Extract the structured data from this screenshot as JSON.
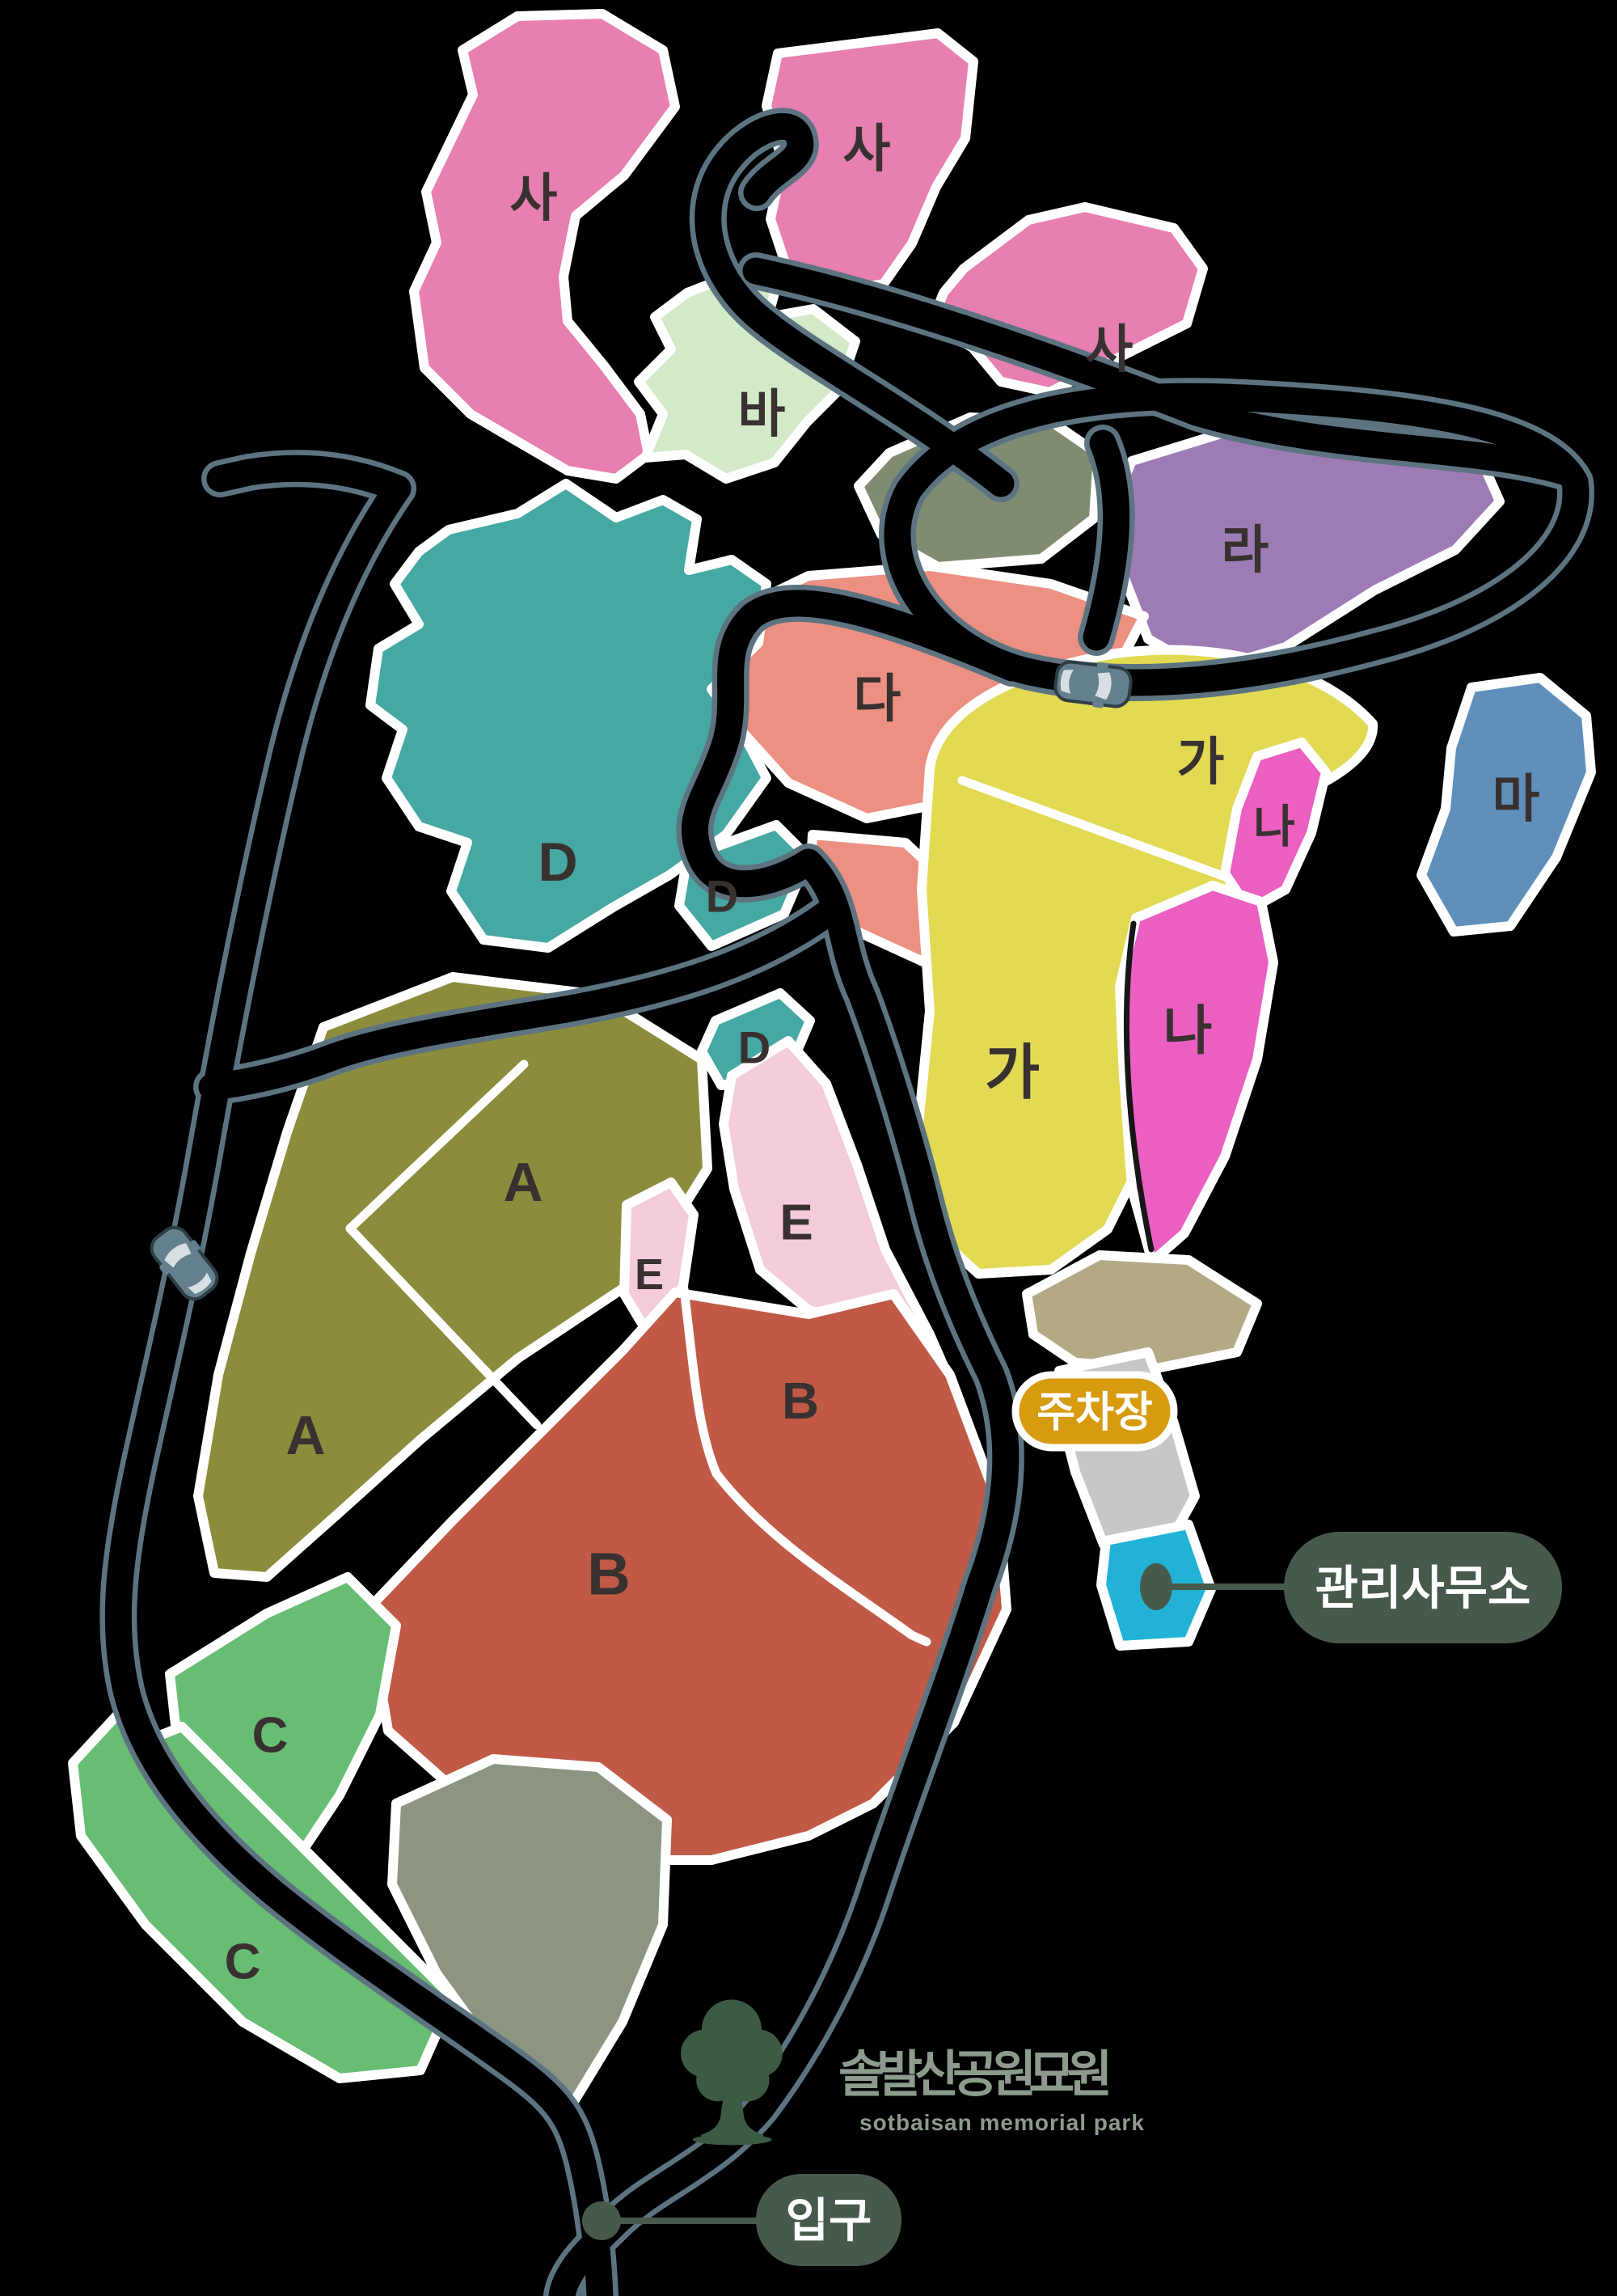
{
  "map": {
    "logo": {
      "title": "솔발산공원묘원",
      "subtitle": "sotbaisan memorial park",
      "tree_color": "#3d5a44",
      "text_color": "#8c9b8c"
    },
    "badges": {
      "parking": {
        "label": "주차장",
        "bg": "#d79b10"
      },
      "office": {
        "label": "관리사무소",
        "bg": "#47594b"
      },
      "entrance": {
        "label": "입구",
        "bg": "#47594b"
      }
    },
    "colors": {
      "background": "#000000",
      "road_edge": "#5d7380",
      "zone_outline": "#ffffff",
      "label_text": "#383130",
      "car": "#64808c"
    },
    "zones": [
      {
        "name": "sa-1",
        "label": "사",
        "color": "#e77fb0"
      },
      {
        "name": "sa-2",
        "label": "사",
        "color": "#e77fb0"
      },
      {
        "name": "sa-3",
        "label": "사",
        "color": "#e77fb0"
      },
      {
        "name": "ba",
        "label": "바",
        "color": "#d3e9c8"
      },
      {
        "name": "hill-top",
        "label": "",
        "color": "#7f8c72"
      },
      {
        "name": "ra",
        "label": "라",
        "color": "#9d7cb5"
      },
      {
        "name": "da",
        "label": "다",
        "color": "#ec9082"
      },
      {
        "name": "da-lower",
        "label": "",
        "color": "#ec9082"
      },
      {
        "name": "d-1",
        "label": "D",
        "color": "#45a8a2"
      },
      {
        "name": "d-2",
        "label": "D",
        "color": "#45a8a2"
      },
      {
        "name": "d-3",
        "label": "D",
        "color": "#45a8a2"
      },
      {
        "name": "ma",
        "label": "마",
        "color": "#5f8fba"
      },
      {
        "name": "ga",
        "label": "가",
        "color": "#e2da52"
      },
      {
        "name": "na-1",
        "label": "나",
        "color": "#ea5fc0"
      },
      {
        "name": "na-2",
        "label": "나",
        "color": "#ea5fc0"
      },
      {
        "name": "a",
        "label": "A",
        "color": "#8b8d3c"
      },
      {
        "name": "e-1",
        "label": "E",
        "color": "#f3cbdb"
      },
      {
        "name": "e-2",
        "label": "E",
        "color": "#f3cbdb"
      },
      {
        "name": "b",
        "label": "B",
        "color": "#c05a47"
      },
      {
        "name": "c-1",
        "label": "C",
        "color": "#67bd72"
      },
      {
        "name": "c-2",
        "label": "C",
        "color": "#67bd72"
      },
      {
        "name": "hill-bottom",
        "label": "",
        "color": "#8b9581"
      },
      {
        "name": "parking-apron",
        "label": "",
        "color": "#b3aa85"
      },
      {
        "name": "parking-strip",
        "label": "",
        "color": "#c7c7c5"
      },
      {
        "name": "office-site",
        "label": "",
        "color": "#22b2d6"
      }
    ],
    "labels": [
      {
        "text": "사"
      },
      {
        "text": "사"
      },
      {
        "text": "사"
      },
      {
        "text": "바"
      },
      {
        "text": "라"
      },
      {
        "text": "다"
      },
      {
        "text": "D"
      },
      {
        "text": "D"
      },
      {
        "text": "D"
      },
      {
        "text": "마"
      },
      {
        "text": "가"
      },
      {
        "text": "나"
      },
      {
        "text": "가"
      },
      {
        "text": "나"
      },
      {
        "text": "A"
      },
      {
        "text": "E"
      },
      {
        "text": "E"
      },
      {
        "text": "A"
      },
      {
        "text": "B"
      },
      {
        "text": "B"
      },
      {
        "text": "C"
      },
      {
        "text": "C"
      }
    ]
  }
}
